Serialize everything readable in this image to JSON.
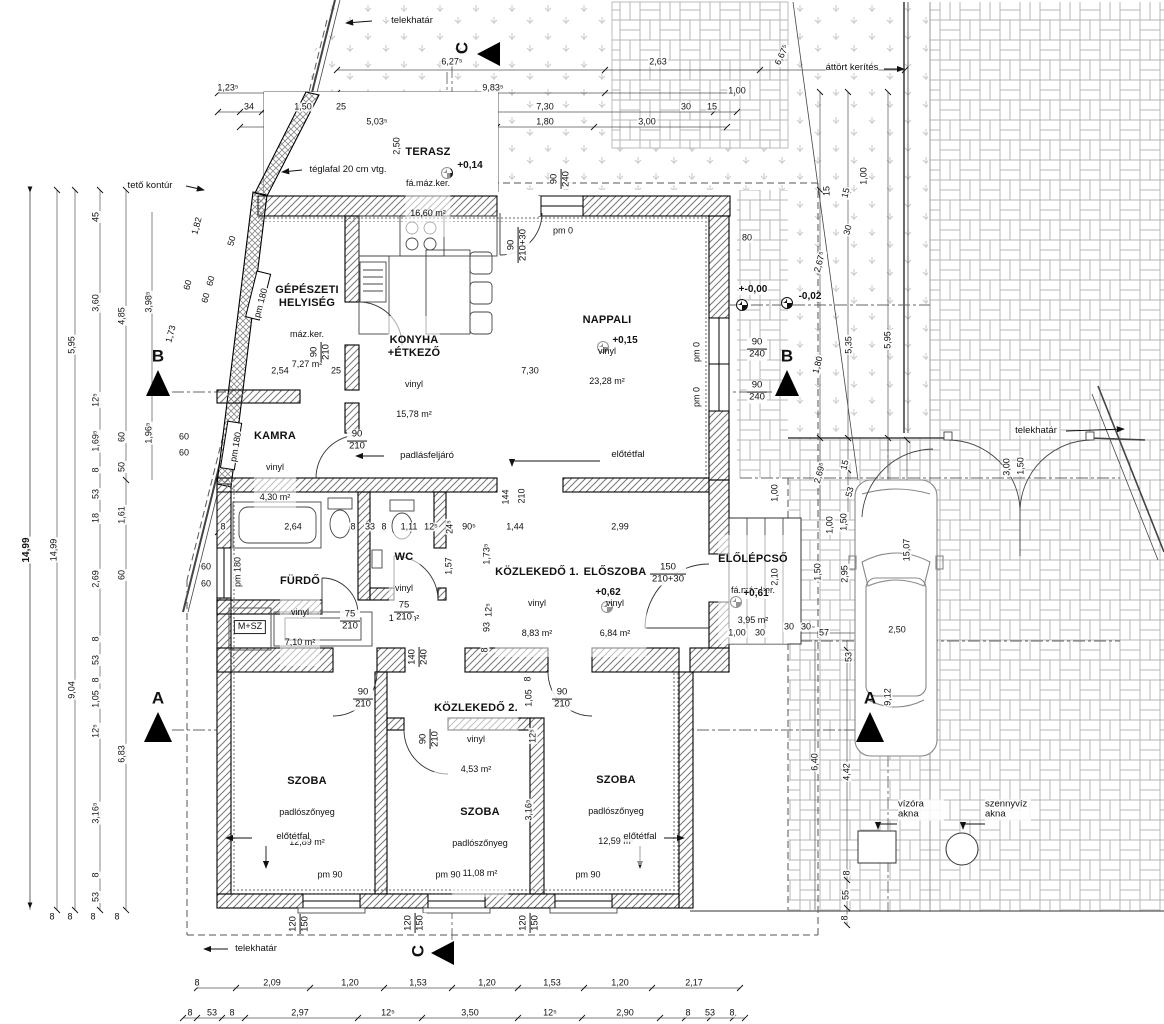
{
  "labels": {
    "telekhatar": "telekhatár",
    "attort_kerites": "áttört kerítés",
    "teglafal": "téglafal 20 cm vtg.",
    "teto_kontur": "tető kontúr",
    "padlasfeljaro": "padlásfeljáró",
    "elotetfal": "előtétfal",
    "msz": "M+SZ",
    "vizora_akna": "vízóra akna",
    "szennyviz_akna": "szennyvíz akna"
  },
  "sections": {
    "a": "A",
    "b": "B",
    "c": "C"
  },
  "rooms": [
    {
      "name": "TERASZ",
      "finish": "fá.máz.ker.",
      "area": "16,60 m²"
    },
    {
      "name": "GÉPÉSZETI\nHELYISÉG",
      "finish": "máz.ker.",
      "area": "7,27 m²"
    },
    {
      "name": "KONYHA\n+ÉTKEZŐ",
      "finish": "vinyl",
      "area": "15,78 m²"
    },
    {
      "name": "NAPPALI",
      "finish": "vinyl",
      "area": "23,28 m²"
    },
    {
      "name": "KAMRA",
      "finish": "vinyl",
      "area": "4,30 m²"
    },
    {
      "name": "FÜRDŐ",
      "finish": "vinyl",
      "area": "7,10 m²"
    },
    {
      "name": "WC",
      "finish": "vinyl",
      "area": "1,74 m²"
    },
    {
      "name": "KÖZLEKEDŐ 1.",
      "finish": "vinyl",
      "area": "8,83 m²"
    },
    {
      "name": "ELŐSZOBA",
      "finish": "vinyl",
      "area": "6,84 m²"
    },
    {
      "name": "ELŐLÉPCSŐ",
      "finish": "fá.máz.ker.",
      "area": "3,95 m²"
    },
    {
      "name": "KÖZLEKEDŐ 2.",
      "finish": "vinyl",
      "area": "4,53 m²"
    },
    {
      "name": "SZOBA",
      "finish": "padlószőnyeg",
      "area": "12,89 m²"
    },
    {
      "name": "SZOBA",
      "finish": "padlószőnyeg",
      "area": "11,08 m²"
    },
    {
      "name": "SZOBA",
      "finish": "padlószőnyeg",
      "area": "12,59 m²"
    }
  ],
  "levels": [
    {
      "t": "+0,14",
      "x": 470,
      "y": 166
    },
    {
      "t": "+0,15",
      "x": 625,
      "y": 341
    },
    {
      "t": "+-0,00",
      "x": 753,
      "y": 290
    },
    {
      "t": "-0,02",
      "x": 810,
      "y": 297
    },
    {
      "t": "+0,62",
      "x": 608,
      "y": 593
    },
    {
      "t": "+0,61",
      "x": 756,
      "y": 594
    }
  ],
  "door_tags": [
    {
      "a": "90",
      "b": "210",
      "x": 321,
      "y": 352,
      "r": -90
    },
    {
      "a": "90",
      "b": "210",
      "x": 357,
      "y": 441
    },
    {
      "a": "90",
      "b": "240",
      "x": 561,
      "y": 179,
      "r": -90
    },
    {
      "a": "90",
      "b": "210+30",
      "x": 518,
      "y": 245,
      "r": -90
    },
    {
      "a": "90",
      "b": "240",
      "x": 757,
      "y": 349
    },
    {
      "a": "90",
      "b": "240",
      "x": 757,
      "y": 392
    },
    {
      "a": "75",
      "b": "210",
      "x": 350,
      "y": 621
    },
    {
      "a": "75",
      "b": "210",
      "x": 404,
      "y": 612
    },
    {
      "a": "140",
      "b": "240",
      "x": 419,
      "y": 657,
      "r": -90
    },
    {
      "a": "150",
      "b": "210+30",
      "x": 668,
      "y": 574
    },
    {
      "a": "90",
      "b": "210",
      "x": 363,
      "y": 699
    },
    {
      "a": "90",
      "b": "210",
      "x": 430,
      "y": 739,
      "r": -90
    },
    {
      "a": "90",
      "b": "210",
      "x": 562,
      "y": 699
    },
    {
      "a": "120",
      "b": "150",
      "x": 300,
      "y": 924,
      "r": -90
    },
    {
      "a": "120",
      "b": "150",
      "x": 415,
      "y": 923,
      "r": -90
    },
    {
      "a": "120",
      "b": "150",
      "x": 530,
      "y": 923,
      "r": -90
    }
  ],
  "dimensions": [
    {
      "t": "6,27⁵",
      "x": 452,
      "y": 62
    },
    {
      "t": "2,63",
      "x": 658,
      "y": 62
    },
    {
      "t": "1,23⁵",
      "x": 228,
      "y": 88
    },
    {
      "t": "9,83⁵",
      "x": 493,
      "y": 88
    },
    {
      "t": "34",
      "x": 249,
      "y": 107
    },
    {
      "t": "1,50",
      "x": 303,
      "y": 107
    },
    {
      "t": "25",
      "x": 341,
      "y": 107
    },
    {
      "t": "7,30",
      "x": 545,
      "y": 107
    },
    {
      "t": "30",
      "x": 686,
      "y": 107
    },
    {
      "t": "15",
      "x": 712,
      "y": 107
    },
    {
      "t": "5,03⁵",
      "x": 377,
      "y": 122
    },
    {
      "t": "1,80",
      "x": 545,
      "y": 122
    },
    {
      "t": "3,00",
      "x": 647,
      "y": 122
    },
    {
      "t": "1,00",
      "x": 737,
      "y": 91
    },
    {
      "t": "2,50",
      "x": 397,
      "y": 146,
      "r": -90
    },
    {
      "t": "6,67⁵",
      "x": 782,
      "y": 55,
      "r": -65
    },
    {
      "t": "1,00",
      "x": 864,
      "y": 176,
      "r": -90
    },
    {
      "t": "15",
      "x": 827,
      "y": 191,
      "r": -90
    },
    {
      "t": "80",
      "x": 747,
      "y": 238
    },
    {
      "t": "1,82",
      "x": 197,
      "y": 226,
      "r": -75
    },
    {
      "t": "50",
      "x": 232,
      "y": 241,
      "r": -75
    },
    {
      "t": "60",
      "x": 211,
      "y": 281,
      "r": -75
    },
    {
      "t": "60",
      "x": 206,
      "y": 298,
      "r": -75
    },
    {
      "t": "60",
      "x": 188,
      "y": 285,
      "r": -75
    },
    {
      "t": "1,73",
      "x": 171,
      "y": 334,
      "r": -75
    },
    {
      "t": "60",
      "x": 184,
      "y": 437
    },
    {
      "t": "60",
      "x": 184,
      "y": 453
    },
    {
      "t": "60",
      "x": 206,
      "y": 567
    },
    {
      "t": "60",
      "x": 206,
      "y": 584
    },
    {
      "t": "14,99",
      "x": 27,
      "y": 550,
      "r": -90,
      "c": "b"
    },
    {
      "t": "14,99",
      "x": 54,
      "y": 550,
      "r": -90
    },
    {
      "t": "5,95",
      "x": 72,
      "y": 345,
      "r": -90
    },
    {
      "t": "9,04",
      "x": 72,
      "y": 690,
      "r": -90
    },
    {
      "t": "45",
      "x": 96,
      "y": 217,
      "r": -90
    },
    {
      "t": "3,60",
      "x": 96,
      "y": 303,
      "r": -90
    },
    {
      "t": "12⁵",
      "x": 96,
      "y": 400,
      "r": -90
    },
    {
      "t": "1,69⁵",
      "x": 96,
      "y": 441,
      "r": -90
    },
    {
      "t": "8",
      "x": 96,
      "y": 470,
      "r": -90
    },
    {
      "t": "53",
      "x": 96,
      "y": 494,
      "r": -90
    },
    {
      "t": "18",
      "x": 96,
      "y": 518,
      "r": -90
    },
    {
      "t": "2,69",
      "x": 96,
      "y": 579,
      "r": -90
    },
    {
      "t": "8",
      "x": 96,
      "y": 639,
      "r": -90
    },
    {
      "t": "53",
      "x": 96,
      "y": 660,
      "r": -90
    },
    {
      "t": "8",
      "x": 96,
      "y": 680,
      "r": -90
    },
    {
      "t": "1,05",
      "x": 96,
      "y": 699,
      "r": -90
    },
    {
      "t": "12⁵",
      "x": 96,
      "y": 731,
      "r": -90
    },
    {
      "t": "3,16⁵",
      "x": 96,
      "y": 813,
      "r": -90
    },
    {
      "t": "8",
      "x": 96,
      "y": 875,
      "r": -90
    },
    {
      "t": "53",
      "x": 96,
      "y": 897,
      "r": -90
    },
    {
      "t": "4,85",
      "x": 122,
      "y": 316,
      "r": -90
    },
    {
      "t": "60",
      "x": 122,
      "y": 437,
      "r": -90
    },
    {
      "t": "50",
      "x": 122,
      "y": 467,
      "r": -90
    },
    {
      "t": "1,61",
      "x": 122,
      "y": 515,
      "r": -90
    },
    {
      "t": "60",
      "x": 122,
      "y": 575,
      "r": -90
    },
    {
      "t": "6,83",
      "x": 122,
      "y": 754,
      "r": -90
    },
    {
      "t": "3,98⁵",
      "x": 149,
      "y": 302,
      "r": -90
    },
    {
      "t": "1,96⁵",
      "x": 149,
      "y": 433,
      "r": -90
    },
    {
      "t": "8",
      "x": 52,
      "y": 917
    },
    {
      "t": "8",
      "x": 70,
      "y": 917
    },
    {
      "t": "8",
      "x": 93,
      "y": 917
    },
    {
      "t": "8",
      "x": 117,
      "y": 917
    },
    {
      "t": "2,54",
      "x": 280,
      "y": 371
    },
    {
      "t": "25",
      "x": 336,
      "y": 371
    },
    {
      "t": "7,30",
      "x": 530,
      "y": 371
    },
    {
      "t": "8",
      "x": 223,
      "y": 527
    },
    {
      "t": "2,64",
      "x": 293,
      "y": 527
    },
    {
      "t": "8",
      "x": 353,
      "y": 527
    },
    {
      "t": "33",
      "x": 370,
      "y": 527
    },
    {
      "t": "8",
      "x": 384,
      "y": 527
    },
    {
      "t": "1,11",
      "x": 409,
      "y": 527
    },
    {
      "t": "12⁵",
      "x": 431,
      "y": 527
    },
    {
      "t": "24⁵",
      "x": 450,
      "y": 527,
      "r": -90
    },
    {
      "t": "90⁵",
      "x": 469,
      "y": 527
    },
    {
      "t": "1,44",
      "x": 515,
      "y": 527
    },
    {
      "t": "2,99",
      "x": 620,
      "y": 527
    },
    {
      "t": "1,57",
      "x": 449,
      "y": 566,
      "r": -90
    },
    {
      "t": "1,73⁵",
      "x": 487,
      "y": 554,
      "r": -90
    },
    {
      "t": "12⁵",
      "x": 489,
      "y": 610,
      "r": -90
    },
    {
      "t": "93",
      "x": 487,
      "y": 627,
      "r": -90
    },
    {
      "t": "8",
      "x": 485,
      "y": 650,
      "r": -90
    },
    {
      "t": "144",
      "x": 506,
      "y": 497,
      "r": -90
    },
    {
      "t": "210",
      "x": 522,
      "y": 496,
      "r": -90
    },
    {
      "t": "pm 0",
      "x": 563,
      "y": 231
    },
    {
      "t": "pm 0",
      "x": 697,
      "y": 352,
      "r": -90
    },
    {
      "t": "pm 0",
      "x": 697,
      "y": 397,
      "r": -90
    },
    {
      "t": "pm 180",
      "x": 261,
      "y": 303,
      "r": -75
    },
    {
      "t": "pm 180",
      "x": 236,
      "y": 447,
      "r": -80
    },
    {
      "t": "pm 180",
      "x": 238,
      "y": 572,
      "r": -90
    },
    {
      "t": "pm 90",
      "x": 330,
      "y": 875
    },
    {
      "t": "pm 90",
      "x": 448,
      "y": 875
    },
    {
      "t": "pm 90",
      "x": 588,
      "y": 875
    },
    {
      "t": "2,67⁵",
      "x": 820,
      "y": 262,
      "r": -75
    },
    {
      "t": "1,80",
      "x": 818,
      "y": 365,
      "r": -75
    },
    {
      "t": "2,69⁵",
      "x": 820,
      "y": 473,
      "r": -75
    },
    {
      "t": "30",
      "x": 848,
      "y": 230,
      "r": -75
    },
    {
      "t": "15",
      "x": 846,
      "y": 193,
      "r": -75
    },
    {
      "t": "5,35",
      "x": 849,
      "y": 345,
      "r": -90
    },
    {
      "t": "15",
      "x": 845,
      "y": 465,
      "r": -75
    },
    {
      "t": "53",
      "x": 850,
      "y": 492,
      "r": -75
    },
    {
      "t": "5,95",
      "x": 888,
      "y": 340,
      "r": -90
    },
    {
      "t": "1,00",
      "x": 775,
      "y": 493,
      "r": -90
    },
    {
      "t": "2,10",
      "x": 775,
      "y": 577,
      "r": -90
    },
    {
      "t": "1,00",
      "x": 830,
      "y": 525,
      "r": -90
    },
    {
      "t": "1,50",
      "x": 844,
      "y": 522,
      "r": -90
    },
    {
      "t": "1,50",
      "x": 818,
      "y": 572,
      "r": -90
    },
    {
      "t": "2,95",
      "x": 845,
      "y": 574,
      "r": -90
    },
    {
      "t": "15,07",
      "x": 907,
      "y": 550,
      "r": -90
    },
    {
      "t": "2,50",
      "x": 897,
      "y": 630
    },
    {
      "t": "9,12",
      "x": 888,
      "y": 697,
      "r": -90
    },
    {
      "t": "53",
      "x": 849,
      "y": 657,
      "r": -90
    },
    {
      "t": "6,40",
      "x": 815,
      "y": 762,
      "r": -90
    },
    {
      "t": "4,42",
      "x": 847,
      "y": 772,
      "r": -90
    },
    {
      "t": "8",
      "x": 847,
      "y": 873,
      "r": -90
    },
    {
      "t": "55",
      "x": 846,
      "y": 895,
      "r": -90
    },
    {
      "t": "8",
      "x": 845,
      "y": 918,
      "r": -90
    },
    {
      "t": "1,00",
      "x": 737,
      "y": 633
    },
    {
      "t": "30",
      "x": 760,
      "y": 633
    },
    {
      "t": "30",
      "x": 789,
      "y": 627
    },
    {
      "t": "30",
      "x": 806,
      "y": 627
    },
    {
      "t": "57",
      "x": 824,
      "y": 633
    },
    {
      "t": "3,00",
      "x": 1007,
      "y": 467,
      "r": -90
    },
    {
      "t": "1,50",
      "x": 1021,
      "y": 466,
      "r": -90
    },
    {
      "t": "8",
      "x": 528,
      "y": 679,
      "r": -90
    },
    {
      "t": "1,05",
      "x": 529,
      "y": 698,
      "r": -90
    },
    {
      "t": "12⁵",
      "x": 533,
      "y": 736,
      "r": -90
    },
    {
      "t": "3,16⁵",
      "x": 529,
      "y": 810,
      "r": -90
    },
    {
      "t": "8",
      "x": 197,
      "y": 983
    },
    {
      "t": "2,09",
      "x": 272,
      "y": 983
    },
    {
      "t": "1,20",
      "x": 350,
      "y": 983
    },
    {
      "t": "1,53",
      "x": 418,
      "y": 983
    },
    {
      "t": "1,20",
      "x": 487,
      "y": 983
    },
    {
      "t": "1,53",
      "x": 552,
      "y": 983
    },
    {
      "t": "1,20",
      "x": 620,
      "y": 983
    },
    {
      "t": "2,17",
      "x": 694,
      "y": 983
    },
    {
      "t": "8",
      "x": 190,
      "y": 1013
    },
    {
      "t": "53",
      "x": 212,
      "y": 1013
    },
    {
      "t": "8",
      "x": 232,
      "y": 1013
    },
    {
      "t": "2,97",
      "x": 300,
      "y": 1013
    },
    {
      "t": "12⁵",
      "x": 388,
      "y": 1013
    },
    {
      "t": "3,50",
      "x": 470,
      "y": 1013
    },
    {
      "t": "12⁵",
      "x": 550,
      "y": 1013
    },
    {
      "t": "2,90",
      "x": 625,
      "y": 1013
    },
    {
      "t": "8",
      "x": 688,
      "y": 1013
    },
    {
      "t": "53",
      "x": 710,
      "y": 1013
    },
    {
      "t": "8",
      "x": 732,
      "y": 1013
    }
  ],
  "colors": {
    "line": "#111111",
    "hatch": "#777777",
    "grass": "#c9c9c9",
    "paving": "#b0b0b0"
  }
}
